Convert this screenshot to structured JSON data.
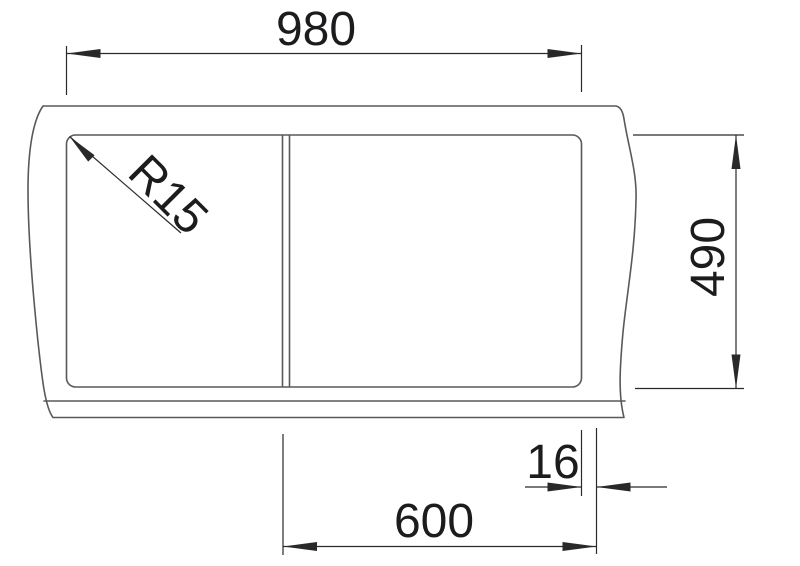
{
  "drawing": {
    "type": "technical-dimension-drawing",
    "subject": "kitchen-sink-top-view",
    "labels": {
      "overall_width": "980",
      "overall_depth": "490",
      "edge_offset": "16",
      "bowl_section_width": "600",
      "corner_radius": "R15"
    }
  },
  "colors": {
    "background": "#ffffff",
    "outline": "#59595b",
    "dimension": "#29292b",
    "text": "#1c1c1e"
  }
}
